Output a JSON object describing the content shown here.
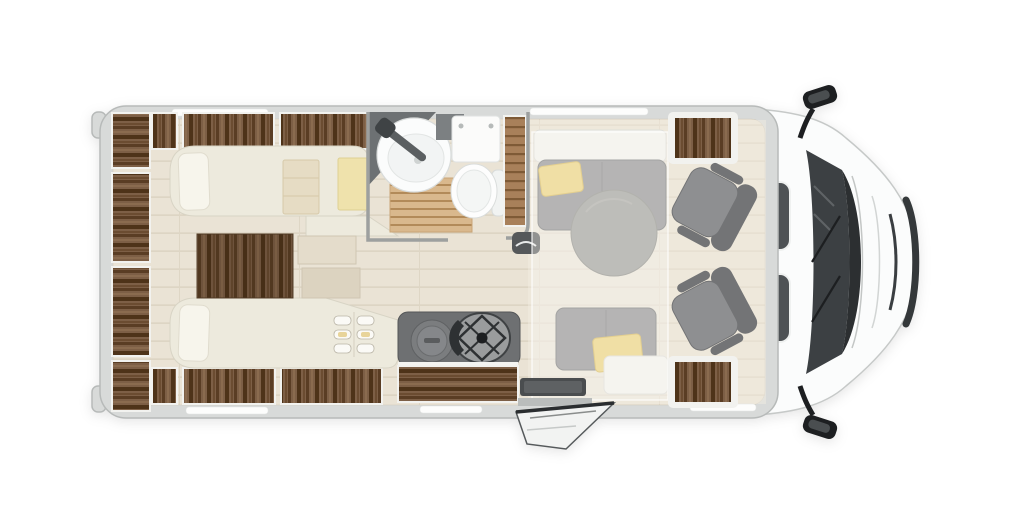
{
  "image": {
    "description": "Top-down floor plan of a semi-integrated motorhome: rear twin single beds with wardrobes, central washroom with basin, shower and toilet, kitchen with two-burner hob and sink, dinette with round table and benches under a translucent drop-down bed, and a driver cab with two swivel seats, side mirrors and an open entrance door",
    "background": "#ffffff"
  },
  "rooms": {
    "bedroom": "Rear bedroom with twin single beds, steps and wardrobes",
    "washroom": "Washroom with round basin, wooden shower grate and toilet",
    "kitchen": "Kitchen block with round sink lid and two-burner hob",
    "dinette": "Dinette with round table, two benches and drop-down bed overlay",
    "cab": "Driver cab with two swivel captain seats",
    "entry": "Entrance with open habitation door and step"
  },
  "colors": {
    "bodyGray": "#d8dad9",
    "bodyEdge": "#b7bab9",
    "cabWhite": "#fbfcfc",
    "glass": "#3c4043",
    "black": "#1d1f21",
    "floorWood": "#eae3d5",
    "floorLine": "#d8cfbd",
    "wallGray": "#9da09f",
    "cream": "#edeadd",
    "creamEdge": "#d8d4c5",
    "seatGray": "#8e8f91",
    "seatGrayDark": "#737476",
    "tableGray": "#9c9d99",
    "pillowYellow": "#eed379",
    "towelYellow": "#efe2ac",
    "blanketBeige": "#e6dcc4",
    "counterGray": "#6e7072",
    "stoveGray": "#9a9c9d",
    "fixtureWhite": "#fbfcfc",
    "slatTan": "#d9b88d",
    "cabinetWood": "#7d5f46",
    "cabinetWoodDark": "#4e3319"
  }
}
